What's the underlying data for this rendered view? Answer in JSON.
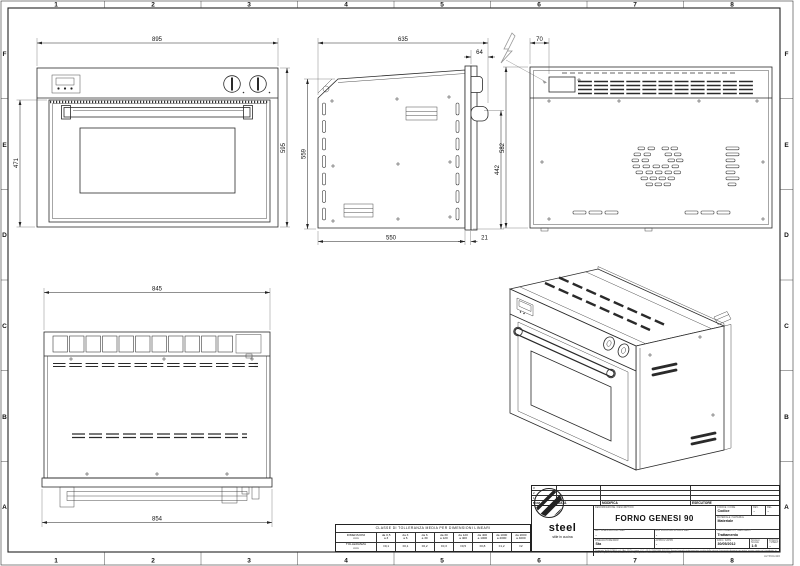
{
  "sheet": {
    "grid_cols": [
      "1",
      "2",
      "3",
      "4",
      "5",
      "6",
      "7",
      "8"
    ],
    "grid_rows": [
      "F",
      "E",
      "D",
      "C",
      "B",
      "A"
    ],
    "size_note": "A2 594x420"
  },
  "dims": {
    "front_width": "895",
    "front_door_height": "471",
    "front_height": "595",
    "side_total_depth": "635",
    "side_handle_depth": "64",
    "side_height": "559",
    "side_right_height": "442",
    "side_body_depth": "550",
    "side_gap": "21",
    "back_terminal_offset": "70",
    "back_height": "582",
    "rear_width": "845",
    "rear_base_width": "854"
  },
  "tolerance_table": {
    "title": "CLASSE DI TOLLERANZA MEDIA PER DIMENSIONI LINEARI",
    "row1_label_top": "DIMENSIONI",
    "row1_label_bot": "mm",
    "row2_label_top": "TOLLERANZA",
    "row2_label_bot": "mm",
    "ranges": [
      [
        "da 0,5",
        "a 3"
      ],
      [
        "da 3",
        "a 6"
      ],
      [
        "da 6",
        "a 30"
      ],
      [
        "da 30",
        "a 120"
      ],
      [
        "da 120",
        "a 400"
      ],
      [
        "da 400",
        "a 1000"
      ],
      [
        "da 1000",
        "a 2000"
      ],
      [
        "da 2000",
        "a 4000"
      ]
    ],
    "tolerances": [
      "±0,1",
      "±0,1",
      "±0,2",
      "±0,3",
      "±0,5",
      "±0,8",
      "±1,2",
      "±2"
    ]
  },
  "title_block": {
    "rev_rows": [
      "3",
      "2",
      "1"
    ],
    "head": {
      "num": "NUM",
      "data": "DATA",
      "modifica": "MODIFICA",
      "esecutore": "ESECUTORE"
    },
    "logo": {
      "brand": "steel",
      "tagline": "stile in cucina"
    },
    "description": {
      "label": "DENOMINAZIONE / DESCRIPTION",
      "value": "FORNO GENESI 90"
    },
    "codice": {
      "label": "CODICE / CODE",
      "value": "Codice"
    },
    "rev": {
      "label": "REV.",
      "value": "-"
    },
    "rel": {
      "label": "REL.",
      "value": "-"
    },
    "materiale": {
      "label": "MATERIALE / MATERIAL",
      "value": "Materiale"
    },
    "trattamento": {
      "label": "TRATTAMENTO / TREATMENT",
      "value": "Trattamento"
    },
    "art_cliente": {
      "label": "ART. CLIENTE/COMP.-REF.",
      "value": "-"
    },
    "dis_forn": {
      "label": "DIS. FORN./SUPPL.DWG REF.",
      "value": "-"
    },
    "disegnatore": {
      "label": "DISEGNATORE/DRW",
      "value": "Sta"
    },
    "approvato": {
      "label": "APPROV./APPD",
      "value": "-"
    },
    "data": {
      "label": "DATA / DATE",
      "value": "30/05/2012"
    },
    "scala": {
      "label": "SCALA / SCALE",
      "value": "1:5"
    },
    "foglio": {
      "label": "FOGLIO / SHEET",
      "value": "-"
    },
    "fine_print": "Proprieta' della STEEL s.r.l. (Art. 2575 e segg. C.C. - R.D. 25/8/1940 N.1411). Senza formale autorizzazione scritta della stessa il presente disegno non potra' essere usato ne' riprodotto, in tutto o in parte, ne' comunicato a terzi. La proprieta' e' tutelata a termini di legge."
  }
}
